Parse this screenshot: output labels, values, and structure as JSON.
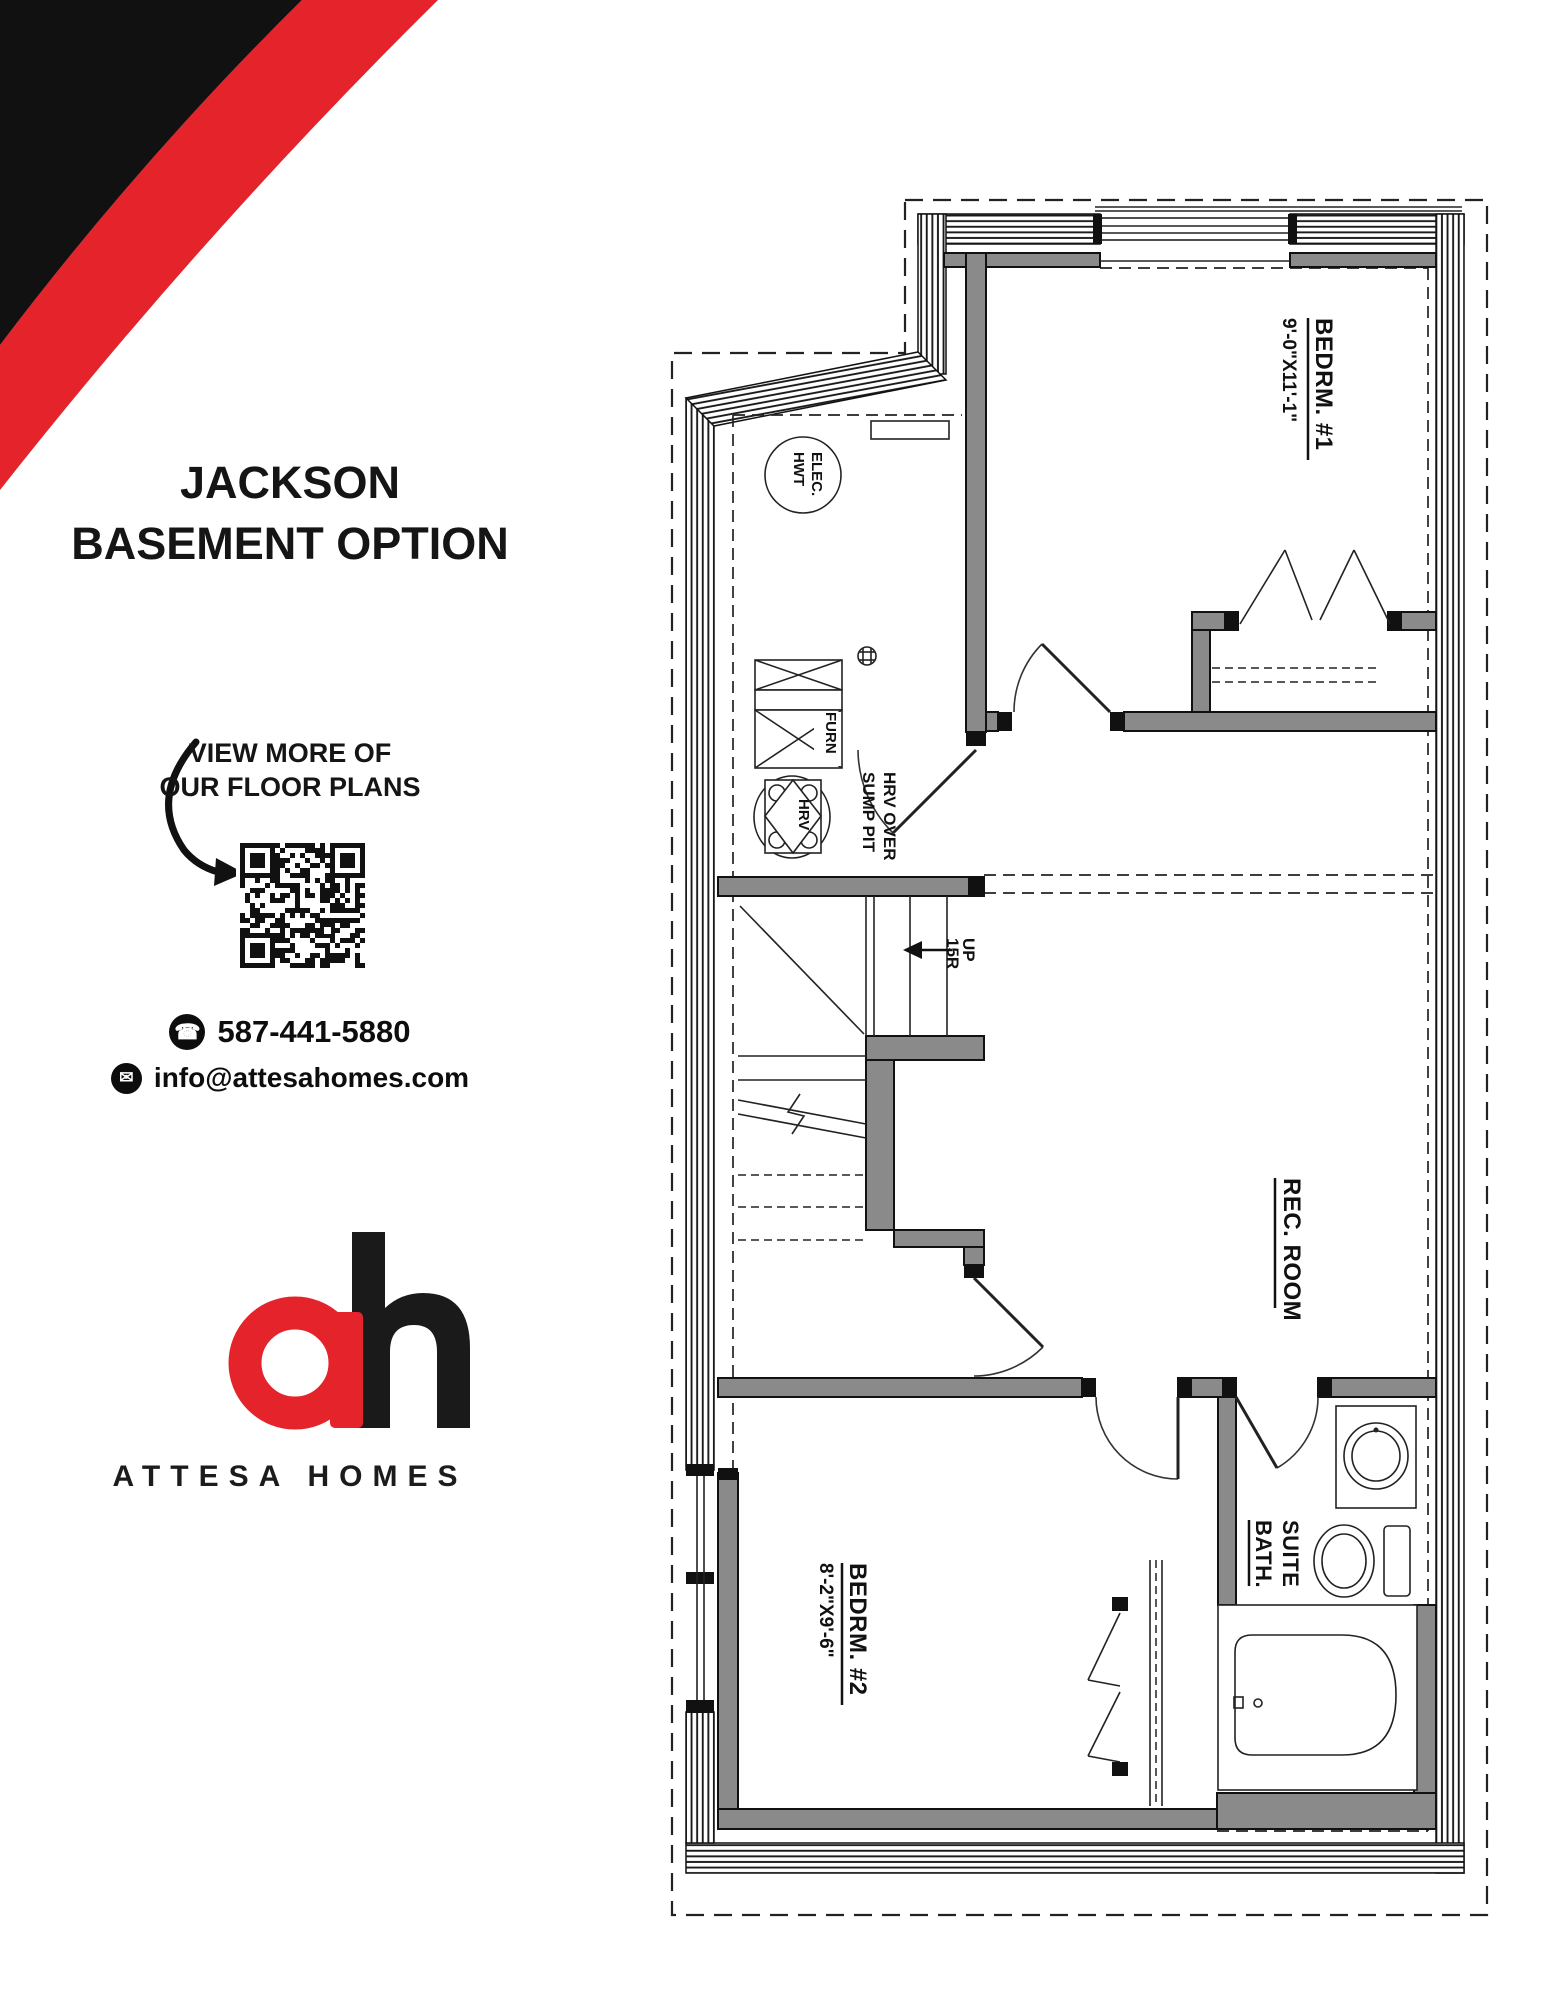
{
  "colors": {
    "accent_red": "#e4232b",
    "ink": "#111111",
    "wall_fill": "#8a8a8a"
  },
  "sidebar": {
    "title_line1": "JACKSON",
    "title_line2": "BASEMENT OPTION",
    "qr_caption_line1": "VIEW MORE OF",
    "qr_caption_line2": "OUR FLOOR PLANS",
    "phone_icon": "☎",
    "phone": "587-441-5880",
    "mail_icon": "✉",
    "email": "info@attesahomes.com",
    "brand_name": "ATTESA HOMES"
  },
  "floorplan": {
    "bedroom1": {
      "name": "BEDRM. #1",
      "dims": "9'-0\"X11'-1\""
    },
    "bedroom2": {
      "name": "BEDRM. #2",
      "dims": "8'-2\"X9'-6\""
    },
    "rec_room": {
      "name": "REC. ROOM"
    },
    "suite_bath": {
      "line1": "SUITE",
      "line2": "BATH."
    },
    "stairs": {
      "line1": "UP",
      "line2": "15R"
    },
    "furnace": "FURN",
    "hrv": "HRV",
    "hrv_note": {
      "line1": "HRV OVER",
      "line2": "SUMP PIT"
    },
    "water_heater": {
      "line1": "ELEC.",
      "line2": "HWT"
    }
  }
}
